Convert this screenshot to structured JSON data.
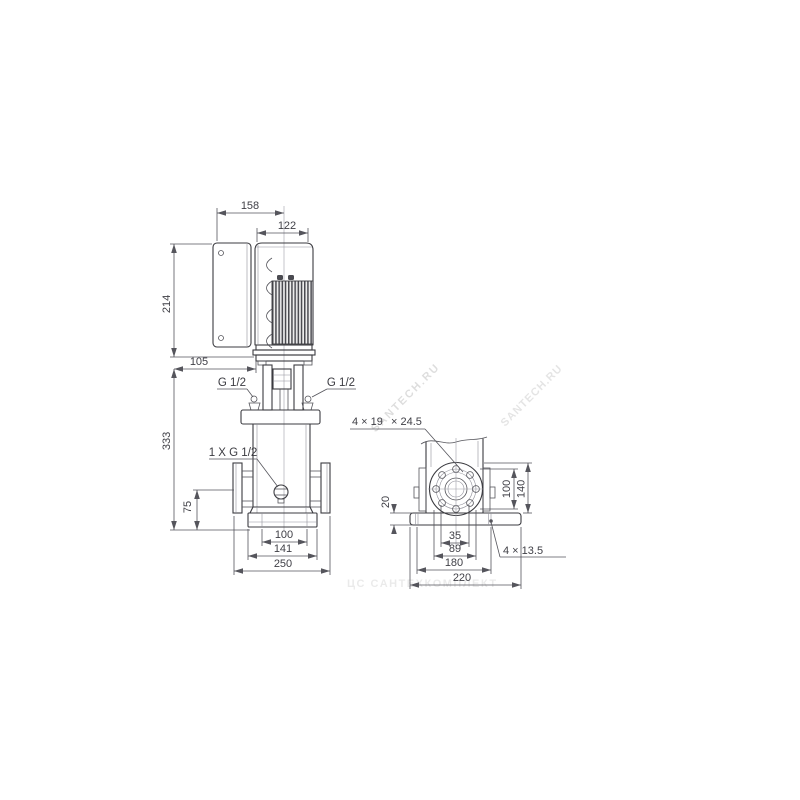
{
  "drawing": {
    "title": "pump-dimensional-drawing",
    "front_view": {
      "dims": {
        "top_width": "158",
        "motor_width": "122",
        "motor_height": "214",
        "box_offset": "105",
        "pump_height": "333",
        "port_height": "75",
        "base_width_inner": "100",
        "base_width_mid": "141",
        "base_width_outer": "250"
      },
      "labels": {
        "plug_left": "G 1/2",
        "plug_right": "G 1/2",
        "drain_port": "1 X G 1/2"
      }
    },
    "side_view": {
      "dims": {
        "flange_holes": "4 × 19",
        "flange_holes_counterbore": "× 24.5",
        "plate_thickness": "20",
        "bolt_circle": "100",
        "flange_od": "140",
        "holes_span_inner": "35",
        "holes_span_outer": "89",
        "base_holes_span": "180",
        "base_width": "220",
        "base_holes": "4 × 13.5"
      }
    },
    "watermarks": {
      "primary": "SANTECH.RU",
      "secondary": "SANTECH.RU",
      "footer": "ЦС САНТЕХКОМПЛЕКТ"
    },
    "colors": {
      "line": "#3b3b40",
      "dimension": "#55555c",
      "watermark": "#d9d9d9",
      "background": "#ffffff"
    }
  }
}
